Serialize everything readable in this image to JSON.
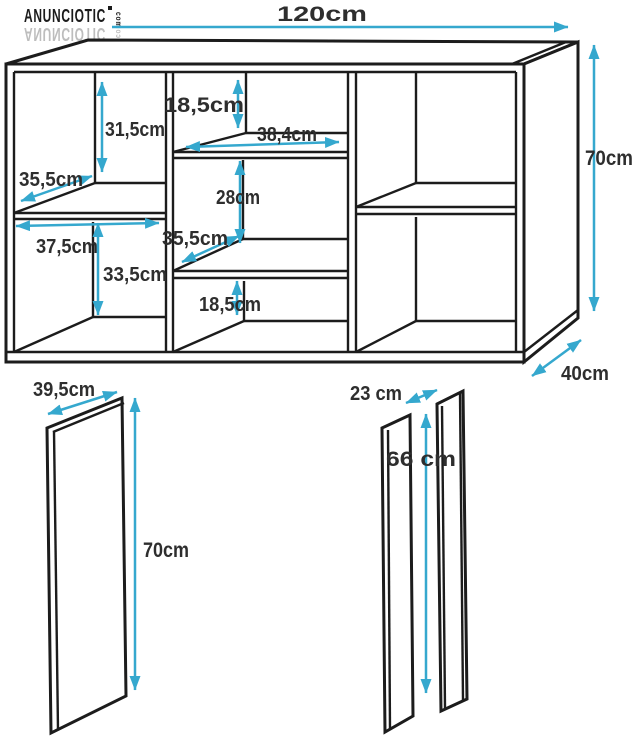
{
  "colors": {
    "accent": "#35a8ce",
    "line": "#1c1c1c",
    "text": "#2e2e2e"
  },
  "logo": {
    "brand": "ANUNCIOTIC",
    "tld": "com"
  },
  "cabinet": {
    "width": "120cm",
    "height": "70cm",
    "depth": "40cm",
    "left_top_cell_height": "31,5cm",
    "left_shelf_depth": "35,5cm",
    "left_bottom_cell_width": "37,5cm",
    "left_bottom_cell_height": "33,5cm",
    "middle_top_cell_height": "18,5cm",
    "middle_cell_width": "38,4cm",
    "middle_cell_height": "28cm",
    "middle_shelf_depth": "35,5cm",
    "middle_bottom_cell_height": "18,5cm"
  },
  "side_panel": {
    "width": "39,5cm",
    "height": "70cm"
  },
  "divider_panels": {
    "width": "23 cm",
    "height": "66 cm"
  }
}
